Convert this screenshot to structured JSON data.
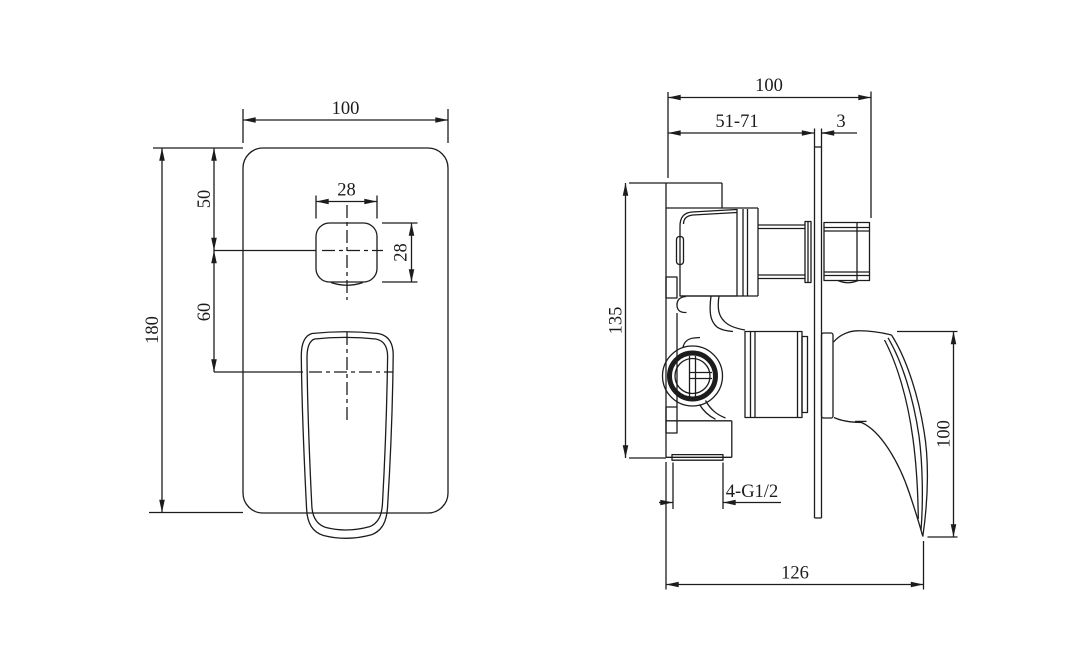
{
  "accent_colors": {
    "line": "#1c1c1c",
    "background": "#ffffff"
  },
  "views": {
    "front": {
      "plate_width_mm": "100",
      "plate_height_mm": "180",
      "top_to_diverter_center_mm": "50",
      "diverter_to_handle_center_mm": "60",
      "diverter_button_width_mm": "28",
      "diverter_button_height_mm": "28"
    },
    "side": {
      "overall_depth_mm": "100",
      "rough_in_depth_range_mm": "51-71",
      "plate_thickness_mm": "3",
      "valve_body_height_mm": "135",
      "handle_drop_mm": "100",
      "thread_callout": "4-G1/2",
      "overall_reach_mm": "126"
    }
  }
}
